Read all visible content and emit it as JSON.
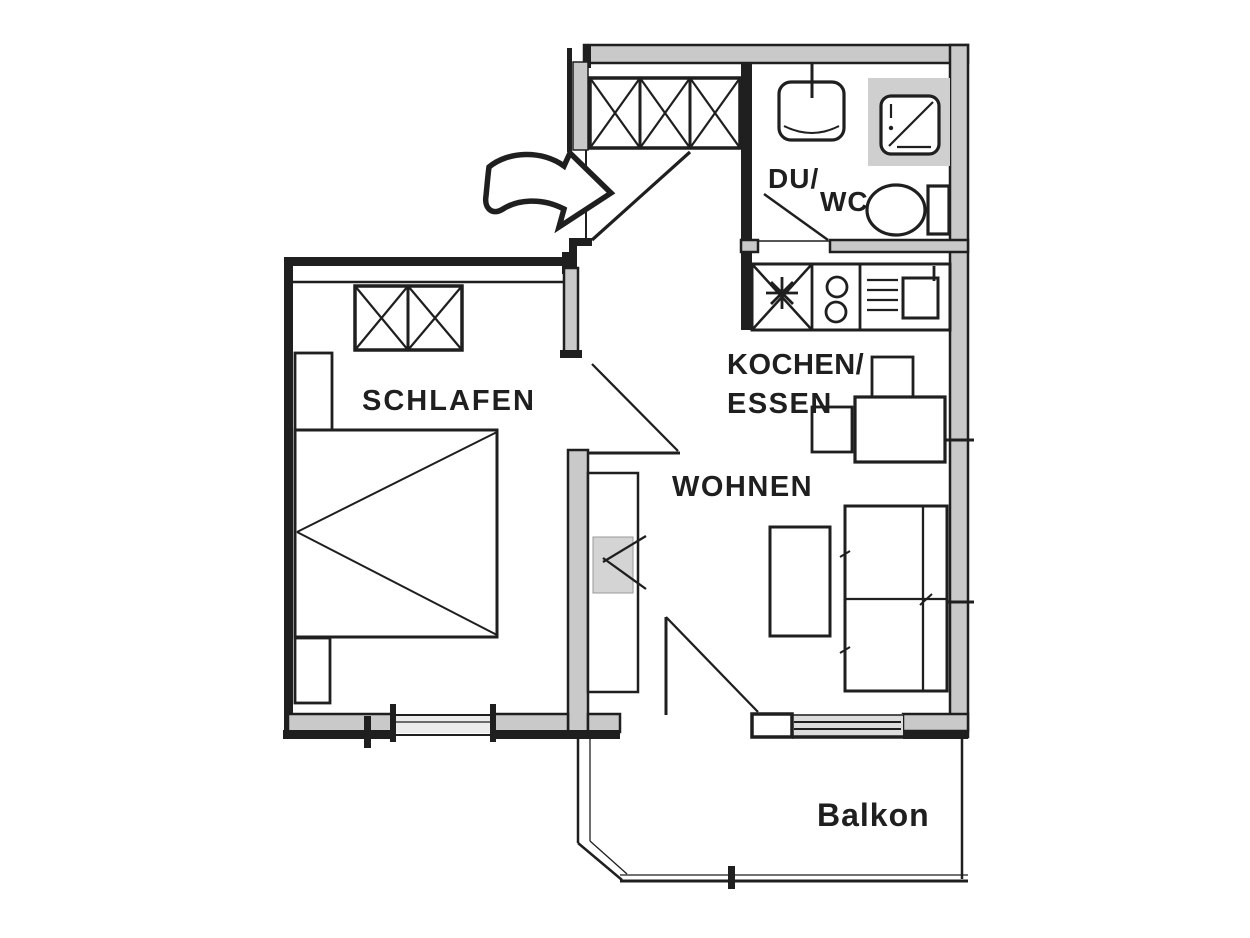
{
  "floorplan": {
    "rooms": {
      "schlafen": {
        "label": "SCHLAFEN"
      },
      "du_wc": {
        "label_line1": "DU/",
        "label_line2": "WC"
      },
      "kochen_essen": {
        "label_line1": "KOCHEN/",
        "label_line2": "ESSEN"
      },
      "wohnen": {
        "label": "WOHNEN"
      },
      "balkon": {
        "label": "Balkon"
      }
    },
    "icons": {
      "entrance_arrow": "curved-arrow-pointing-right-at-entrance-door"
    }
  },
  "colors": {
    "background": "#ffffff",
    "wall_dark": "#1f1f1f",
    "wall_fill": "#c9c9c9",
    "light_fill": "#ececec",
    "window_fill": "#dcdcdc",
    "shower_fill": "#cfcfcf",
    "tv_fill": "#d4d4d4"
  }
}
